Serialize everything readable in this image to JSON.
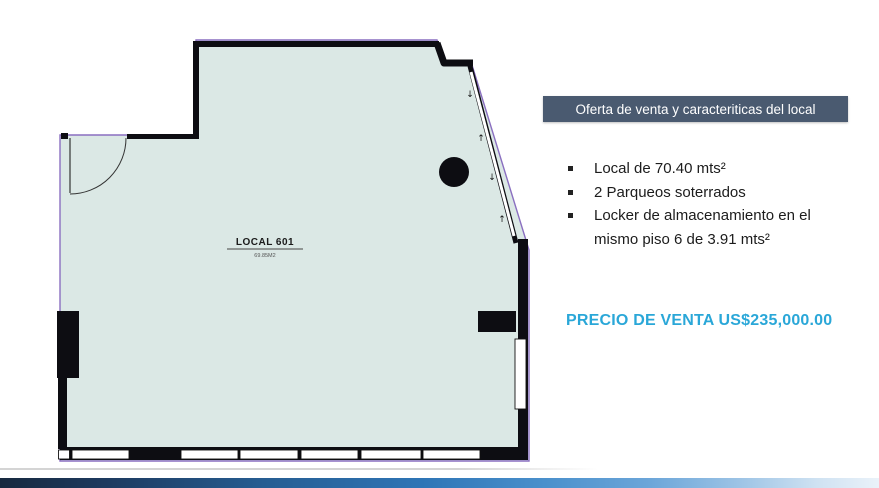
{
  "slide": {
    "title_box": {
      "label": "Oferta de venta y caracteriticas del local",
      "bg_color": "#4a5a70"
    },
    "bullets": [
      "Local de 70.40 mts²",
      "2 Parqueos soterrados",
      "Locker de almacenamiento en el mismo piso 6 de 3.91 mts²"
    ],
    "price_line": "PRECIO DE VENTA US$235,000.00",
    "accent_colors": {
      "price": "#2aa7d8",
      "bottom_bar_left": "#17293f",
      "bottom_bar_mid": "#2e75b6",
      "bottom_bar_right": "#eaf2f9"
    }
  },
  "floorplan": {
    "unit_label": "LOCAL 601",
    "unit_area": "69.85M2",
    "colors": {
      "floor_fill": "#dbe8e5",
      "outline": "#8a6fc0",
      "walls": "#0d0d12"
    }
  }
}
